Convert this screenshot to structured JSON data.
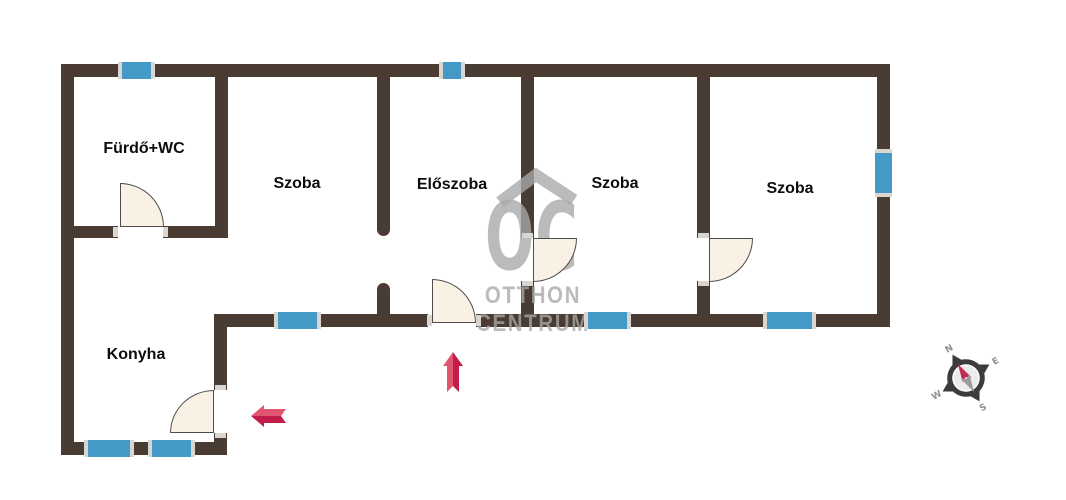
{
  "plan": {
    "rooms": [
      {
        "id": "furdo-wc",
        "label": "Fürdő+WC"
      },
      {
        "id": "szoba-1",
        "label": "Szoba"
      },
      {
        "id": "eloszoba",
        "label": "Előszoba"
      },
      {
        "id": "szoba-2",
        "label": "Szoba"
      },
      {
        "id": "szoba-3",
        "label": "Szoba"
      },
      {
        "id": "konyha",
        "label": "Konyha"
      }
    ],
    "features": {
      "windows": 8,
      "doors": 5,
      "entrance_arrows": [
        {
          "id": "entrance-up",
          "direction": "up"
        },
        {
          "id": "entrance-left",
          "direction": "left"
        }
      ]
    }
  },
  "watermark": {
    "logo_text": "OC",
    "line1": "OTTHON",
    "line2": "CENTRUM"
  },
  "compass": {
    "north": "N",
    "east": "E",
    "south": "S",
    "west": "W",
    "rotation_deg": -30
  },
  "colors": {
    "background": "#ffffff",
    "wall": "#4a3c32",
    "window": "#4599c6",
    "window_cap": "#d9d5d1",
    "door_fill": "#f9f2e4",
    "door_stroke": "#4d4d4d",
    "label": "#0d0d0d",
    "watermark": "rgba(168,168,168,0.78)",
    "arrow_light": "#e25570",
    "arrow_dark": "#c11c4a",
    "compass_ring": "#3c3c3c",
    "compass_face": "#ececec",
    "compass_letter": "#8f8f8f",
    "compass_needle_n": "#c22a4e",
    "compass_needle_s": "#9c9c9c"
  }
}
